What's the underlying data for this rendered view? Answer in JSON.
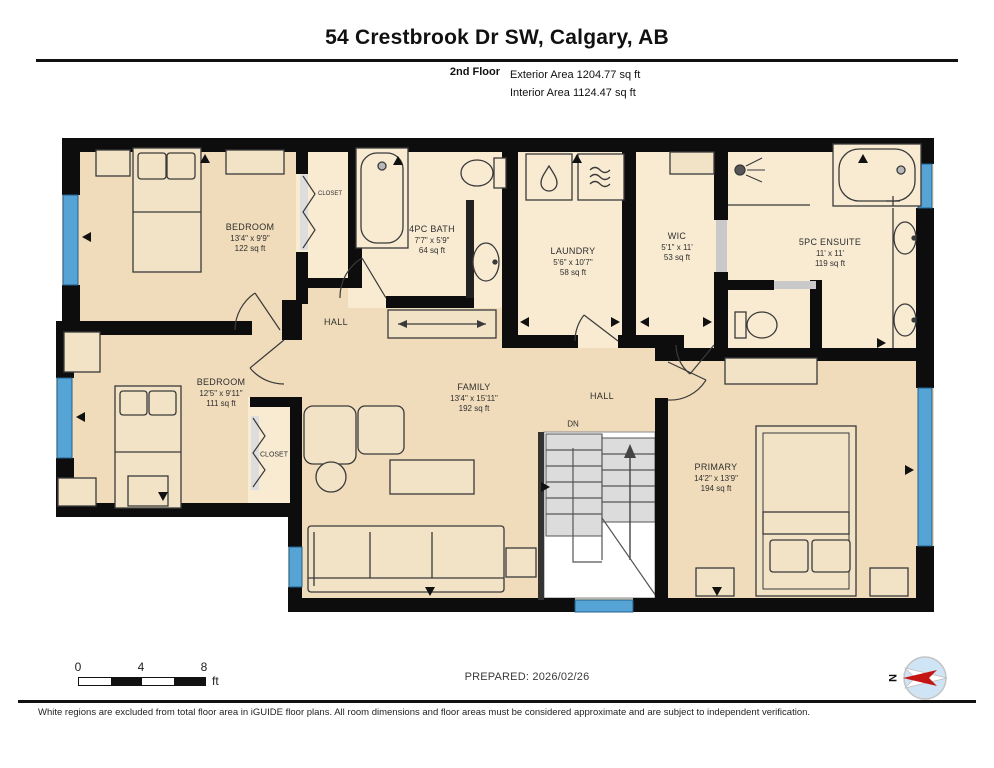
{
  "header": {
    "title": "54 Crestbrook Dr SW, Calgary, AB",
    "floor_label": "2nd Floor",
    "exterior_area": "Exterior Area 1204.77 sq ft",
    "interior_area": "Interior Area 1124.47 sq ft"
  },
  "rooms": [
    {
      "id": "bedroom-top",
      "name": "BEDROOM",
      "dims": "13'4\" x 9'9\"",
      "area": "122 sq ft"
    },
    {
      "id": "bath",
      "name": "4PC BATH",
      "dims": "7'7\" x 5'9\"",
      "area": "64 sq ft"
    },
    {
      "id": "laundry",
      "name": "LAUNDRY",
      "dims": "5'6\" x 10'7\"",
      "area": "58 sq ft"
    },
    {
      "id": "wic",
      "name": "WIC",
      "dims": "5'1\" x 11'",
      "area": "53 sq ft"
    },
    {
      "id": "ensuite",
      "name": "5PC ENSUITE",
      "dims": "11' x 11'",
      "area": "119 sq ft"
    },
    {
      "id": "bedroom-left",
      "name": "BEDROOM",
      "dims": "12'5\" x 9'11\"",
      "area": "111 sq ft"
    },
    {
      "id": "family",
      "name": "FAMILY",
      "dims": "13'4\" x 15'11\"",
      "area": "192 sq ft"
    },
    {
      "id": "primary",
      "name": "PRIMARY",
      "dims": "14'2\" x 13'9\"",
      "area": "194 sq ft"
    }
  ],
  "labels": {
    "hall_upper": "HALL",
    "hall_lower": "HALL",
    "stairs_down": "DN",
    "closet_upper": "CLOSET",
    "closet_lower": "CLOSET"
  },
  "scale": {
    "tick0": "0",
    "tick1": "4",
    "tick2": "8",
    "unit": "ft"
  },
  "compass": {
    "north": "N"
  },
  "footer": {
    "prepared": "PREPARED: 2026/02/26",
    "disclaimer": "White regions are excluded from total floor area in iGUIDE floor plans. All room dimensions and floor areas must be considered approximate and are subject to independent verification."
  },
  "colors": {
    "wall": "#0d0d0d",
    "room_fill": "#f0dcba",
    "wet_room_fill": "#f8ebd2",
    "window_blue": "#55a4d5",
    "compass_red": "#c41414",
    "compass_blue": "#cfe4f4"
  }
}
